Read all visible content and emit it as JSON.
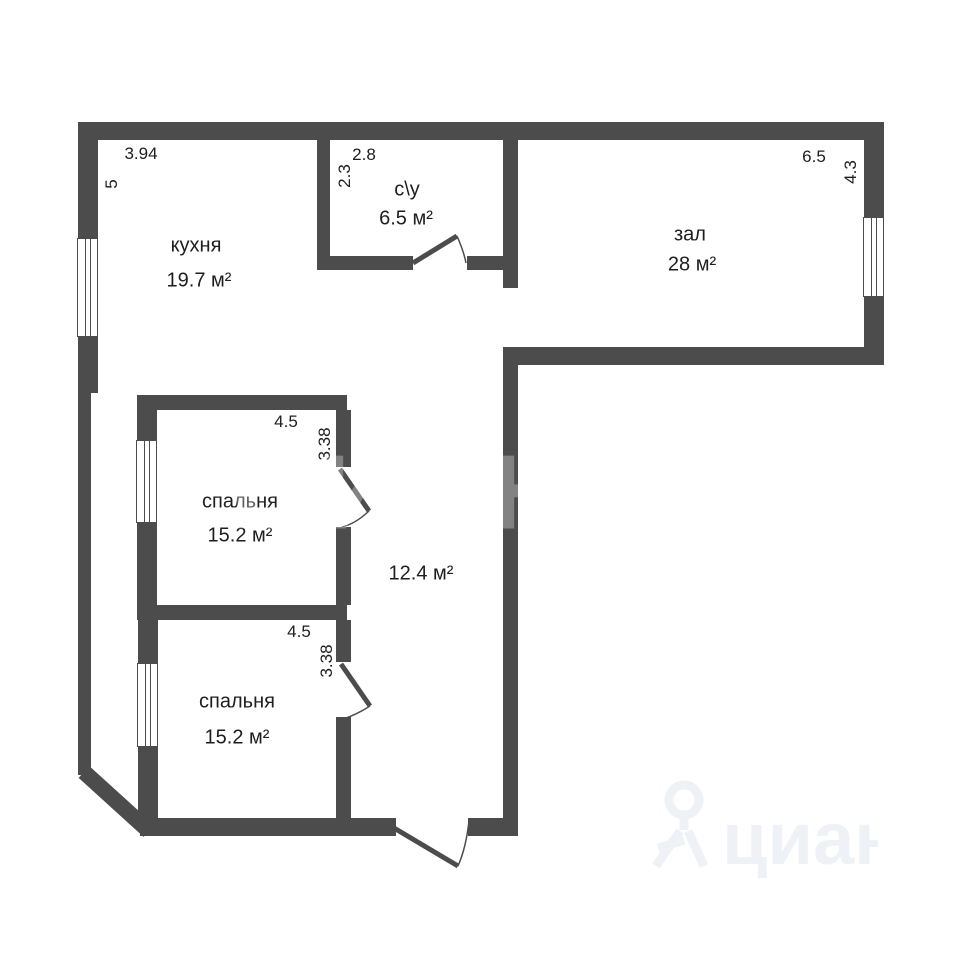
{
  "canvas": {
    "background": "#ffffff",
    "wall_color": "#4c4c4c",
    "text_color": "#1e1e1e",
    "watermark_color": "#eef2f6"
  },
  "rooms": {
    "kitchen": {
      "name": "кухня",
      "area": "19.7 м²",
      "width_dim": "3.94",
      "height_dim": "5"
    },
    "bathroom": {
      "name": "с\\у",
      "area": "6.5 м²",
      "width_dim": "2.8",
      "height_dim": "2.3"
    },
    "hall": {
      "name": "зал",
      "area": "28 м²",
      "width_dim": "6.5",
      "height_dim": "4.3"
    },
    "bedroom1": {
      "name": "спальня",
      "area": "15.2 м²",
      "width_dim": "4.5",
      "height_dim": "3.38"
    },
    "bedroom2": {
      "name": "спальня",
      "area": "15.2 м²",
      "width_dim": "4.5",
      "height_dim": "3.38"
    },
    "corridor": {
      "area": "12.4 м²"
    }
  },
  "watermark": {
    "center_text": "циан",
    "logo_text": "циан"
  }
}
